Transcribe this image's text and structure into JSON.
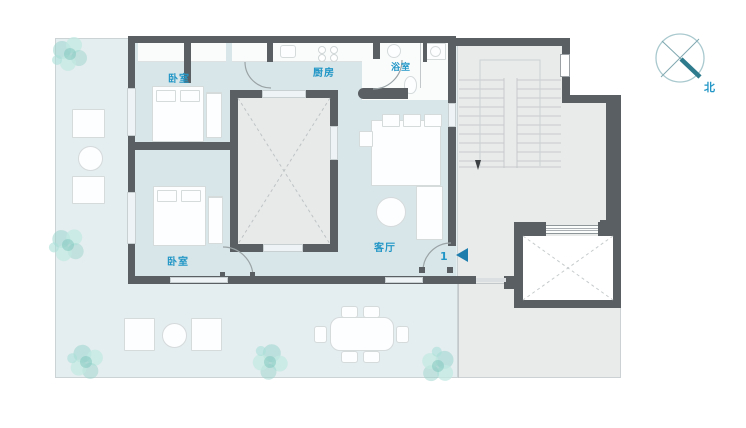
{
  "plan": {
    "labels": {
      "bedroom_top": "卧室",
      "kitchen": "厨房",
      "bathroom": "浴室",
      "bedroom_bottom": "卧室",
      "living_room": "客厅",
      "entrance_number": "1",
      "north": "北"
    },
    "colors": {
      "wall": "#5a5f63",
      "indoor_floor": "#d9e6e9",
      "terrace_floor": "#e4edef",
      "common_area_floor": "#e9ebeb",
      "label_blue": "#2296c6",
      "tree_teal": "#9bd6ce",
      "compass_needle": "#2e7b8d",
      "furniture": "#fdfeff"
    }
  }
}
